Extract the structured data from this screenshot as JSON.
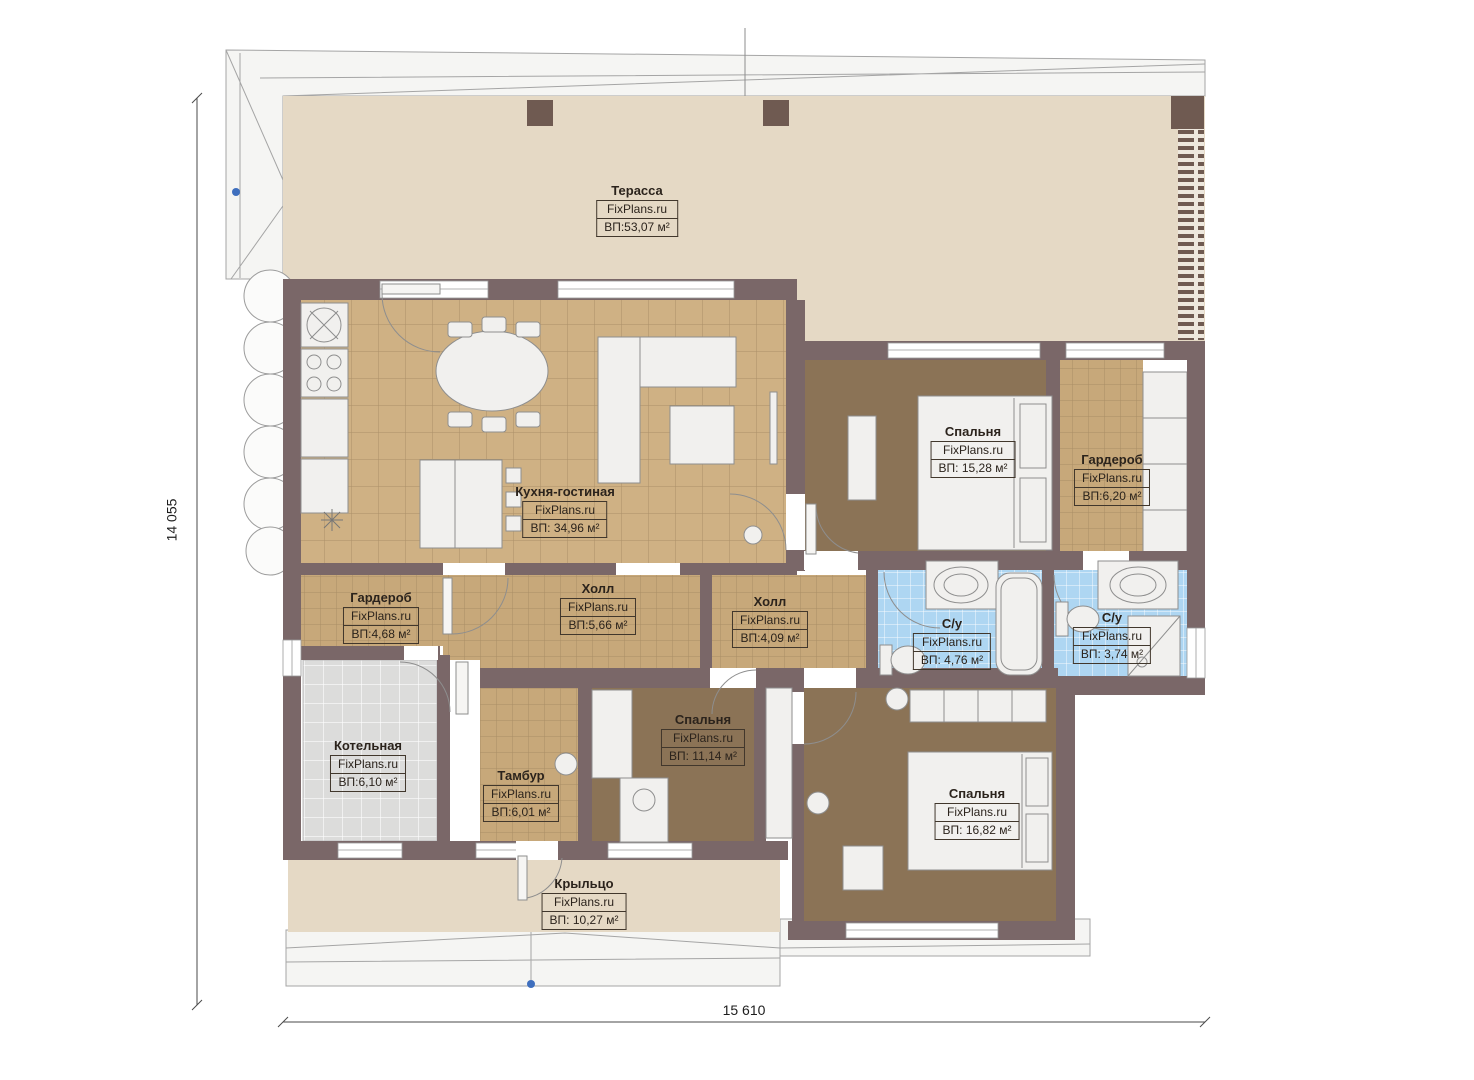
{
  "title": "Floor plan",
  "brand": "FixPlans.ru",
  "dimensions": {
    "left": "14 055",
    "bottom": "15 610"
  },
  "rooms": [
    {
      "id": "terrace",
      "name": "Терасса",
      "brand": "FixPlans.ru",
      "area": "ВП:53,07 м²"
    },
    {
      "id": "kitchen-living",
      "name": "Кухня-гостиная",
      "brand": "FixPlans.ru",
      "area": "ВП: 34,96 м²"
    },
    {
      "id": "bedroom-1",
      "name": "Спальня",
      "brand": "FixPlans.ru",
      "area": "ВП: 15,28 м²"
    },
    {
      "id": "wardrobe-1",
      "name": "Гардероб",
      "brand": "FixPlans.ru",
      "area": "ВП:6,20 м²"
    },
    {
      "id": "wardrobe-2",
      "name": "Гардероб",
      "brand": "FixPlans.ru",
      "area": "ВП:4,68 м²"
    },
    {
      "id": "hall-1",
      "name": "Холл",
      "brand": "FixPlans.ru",
      "area": "ВП:5,66 м²"
    },
    {
      "id": "hall-2",
      "name": "Холл",
      "brand": "FixPlans.ru",
      "area": "ВП:4,09 м²"
    },
    {
      "id": "bathroom-1",
      "name": "С/у",
      "brand": "FixPlans.ru",
      "area": "ВП: 4,76 м²"
    },
    {
      "id": "bathroom-2",
      "name": "С/у",
      "brand": "FixPlans.ru",
      "area": "ВП: 3,74 м²"
    },
    {
      "id": "boiler-room",
      "name": "Котельная",
      "brand": "FixPlans.ru",
      "area": "ВП:6,10 м²"
    },
    {
      "id": "vestibule",
      "name": "Тамбур",
      "brand": "FixPlans.ru",
      "area": "ВП:6,01 м²"
    },
    {
      "id": "bedroom-2",
      "name": "Спальня",
      "brand": "FixPlans.ru",
      "area": "ВП: 11,14 м²"
    },
    {
      "id": "bedroom-3",
      "name": "Спальня",
      "brand": "FixPlans.ru",
      "area": "ВП: 16,82 м²"
    },
    {
      "id": "porch",
      "name": "Крыльцо",
      "brand": "FixPlans.ru",
      "area": "ВП: 10,27 м²"
    }
  ],
  "colors": {
    "wall": "#7a6768",
    "terrace_floor": "#e5d9c5",
    "kitchen_tile": "#cfb184",
    "corridor_tile": "#c7a87a",
    "bedroom_floor": "#8b7356",
    "bathroom_tile": "#aed6f2",
    "boiler_tile": "#dcdcdb",
    "marker_blue": "#3f6fbe"
  }
}
